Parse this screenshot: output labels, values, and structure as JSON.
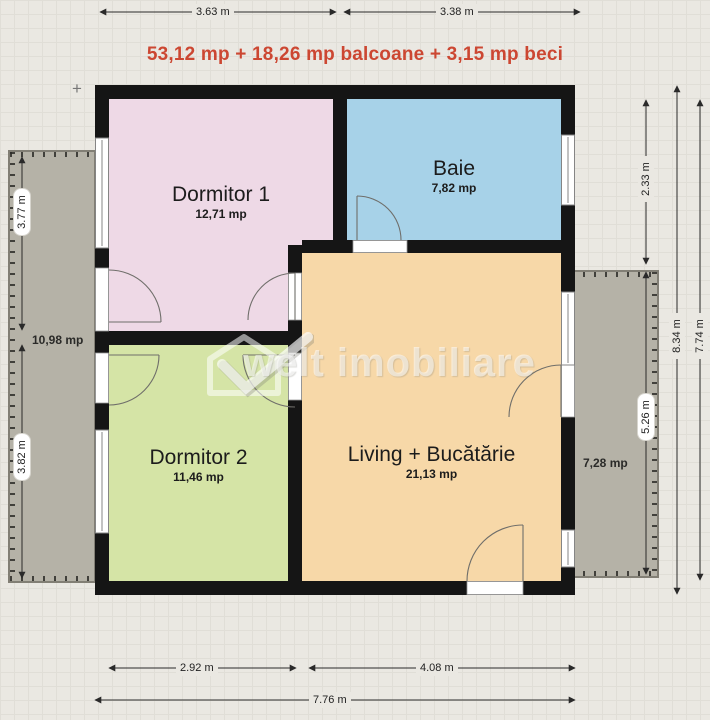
{
  "title": {
    "text": "53,12 mp + 18,26 mp balcoane + 3,15 mp beci",
    "color": "#cc4732"
  },
  "watermark": {
    "brand": "welt imobiliare"
  },
  "rooms": {
    "dormitor1": {
      "name": "Dormitor 1",
      "area": "12,71 mp",
      "color": "#eed9e6"
    },
    "baie": {
      "name": "Baie",
      "area": "7,82 mp",
      "color": "#a7d2e8"
    },
    "dormitor2": {
      "name": "Dormitor 2",
      "area": "11,46 mp",
      "color": "#d5e4a6"
    },
    "living": {
      "name": "Living + Bucătărie",
      "area": "21,13 mp",
      "color": "#f7d8a8"
    }
  },
  "balconies": {
    "left": {
      "area": "10,98 mp"
    },
    "right": {
      "area": "7,28 mp"
    }
  },
  "dimensions": {
    "top": [
      "3.63 m",
      "3.38 m"
    ],
    "bottom_inner": [
      "2.92 m",
      "4.08 m"
    ],
    "bottom_total": "7.76 m",
    "left": [
      "3.77 m",
      "3.82 m"
    ],
    "right_upper": "2.33 m",
    "right_balcony": "5.26 m",
    "right_total_outer": "8.34 m",
    "right_total_inner": "7.74 m"
  },
  "marks": {
    "plus": "+"
  },
  "colors": {
    "paper": "#eae8e2",
    "wall": "#151515",
    "balcony": "#b5b2a7",
    "dimension_text": "#222222",
    "title_red": "#cc4732"
  }
}
